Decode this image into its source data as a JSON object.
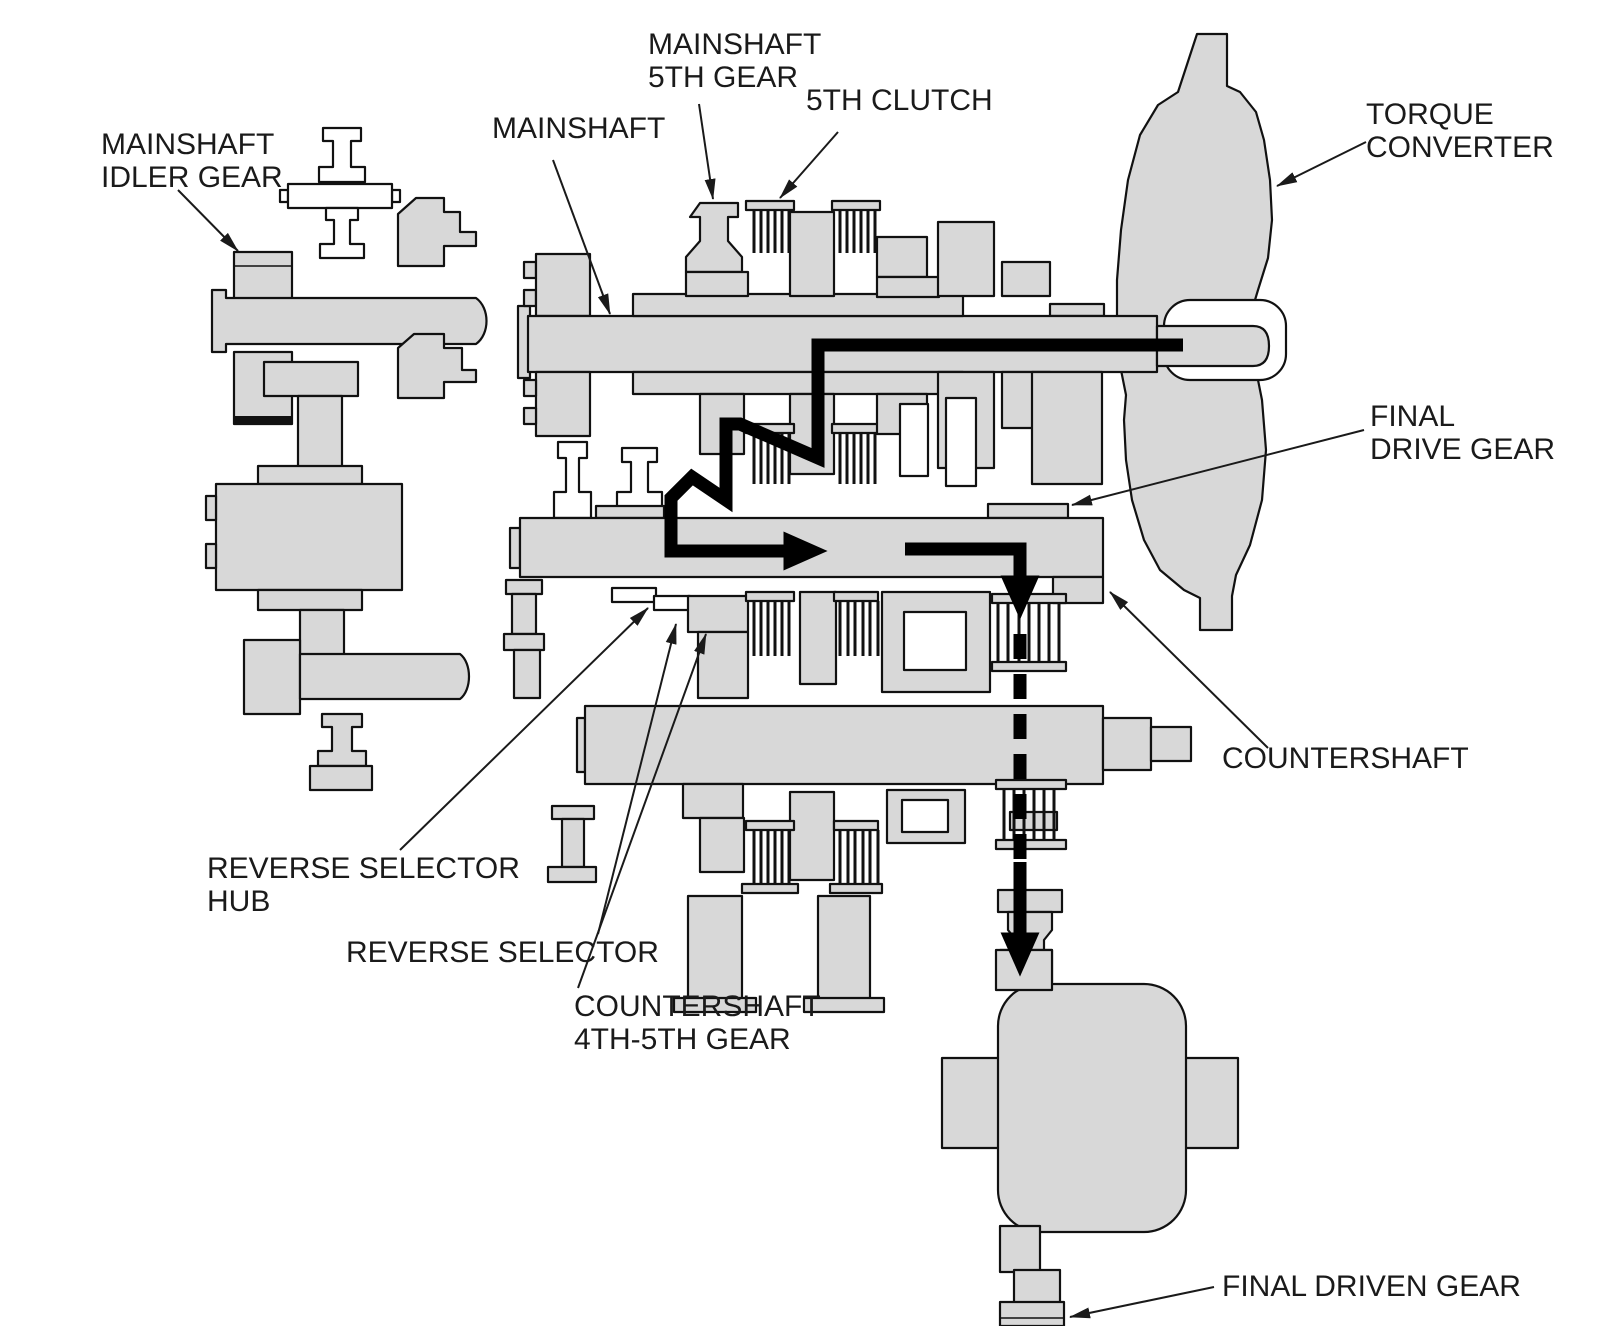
{
  "diagram": {
    "kind": "automatic-transmission-cross-section-power-flow",
    "labels": {
      "mainshaft_idler_gear": {
        "lines": [
          "MAINSHAFT",
          "IDLER GEAR"
        ]
      },
      "mainshaft": {
        "lines": [
          "MAINSHAFT"
        ]
      },
      "mainshaft_5th_gear": {
        "lines": [
          "MAINSHAFT",
          "5TH GEAR"
        ]
      },
      "fifth_clutch": {
        "lines": [
          "5TH CLUTCH"
        ]
      },
      "torque_converter": {
        "lines": [
          "TORQUE",
          "CONVERTER"
        ]
      },
      "final_drive_gear": {
        "lines": [
          "FINAL",
          "DRIVE GEAR"
        ]
      },
      "countershaft": {
        "lines": [
          "COUNTERSHAFT"
        ]
      },
      "reverse_selector_hub": {
        "lines": [
          "REVERSE SELECTOR",
          "HUB"
        ]
      },
      "reverse_selector": {
        "lines": [
          "REVERSE SELECTOR"
        ]
      },
      "countershaft_4th_5th_gear": {
        "lines": [
          "COUNTERSHAFT",
          "4TH-5TH GEAR"
        ]
      },
      "final_driven_gear": {
        "lines": [
          "FINAL DRIVEN GEAR"
        ]
      }
    },
    "colors": {
      "part_fill": "#d8d8d8",
      "outline": "#111111",
      "power_flow": "#000000",
      "background": "#ffffff"
    }
  }
}
